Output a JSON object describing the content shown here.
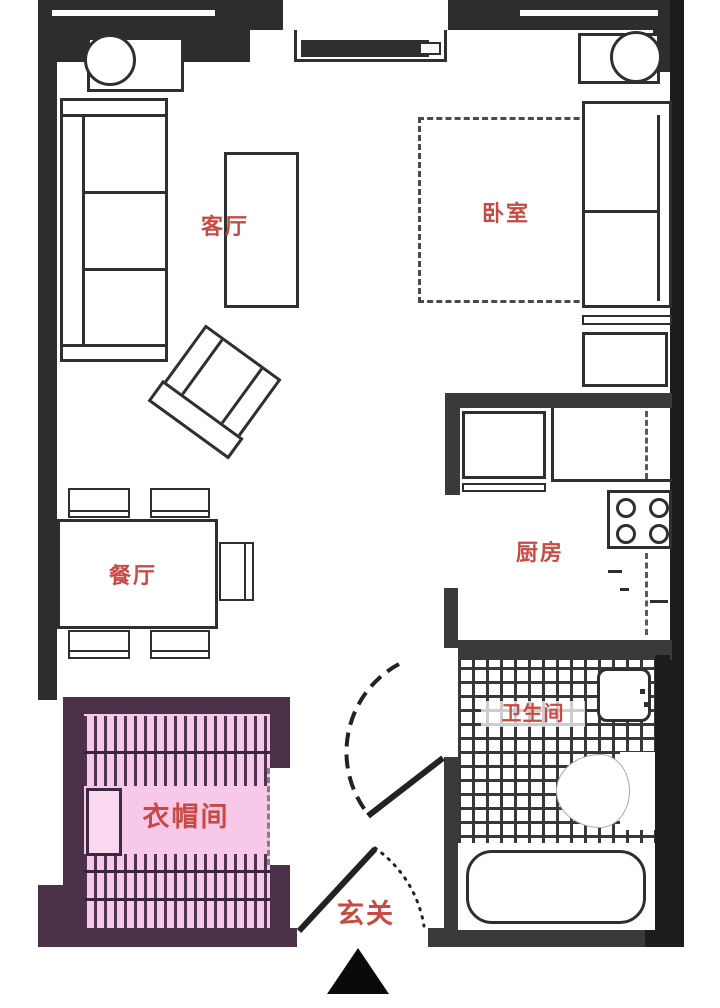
{
  "plan": {
    "rooms": {
      "living": {
        "label": "客厅"
      },
      "bedroom": {
        "label": "卧室"
      },
      "dining": {
        "label": "餐厅"
      },
      "kitchen": {
        "label": "厨房"
      },
      "bathroom": {
        "label": "卫生间"
      },
      "cloakroom": {
        "label": "衣帽间"
      },
      "entrance": {
        "label": "玄关"
      }
    },
    "colors": {
      "label_red": "#c84a44",
      "cloakroom_fill": "#f8c8e8",
      "cloakroom_wall": "#4b3148",
      "wall_dark": "#2d2d2d",
      "wall_medium": "#3a3a3a",
      "wall_black": "#1c1c1c",
      "line": "#2f2f2f"
    }
  }
}
